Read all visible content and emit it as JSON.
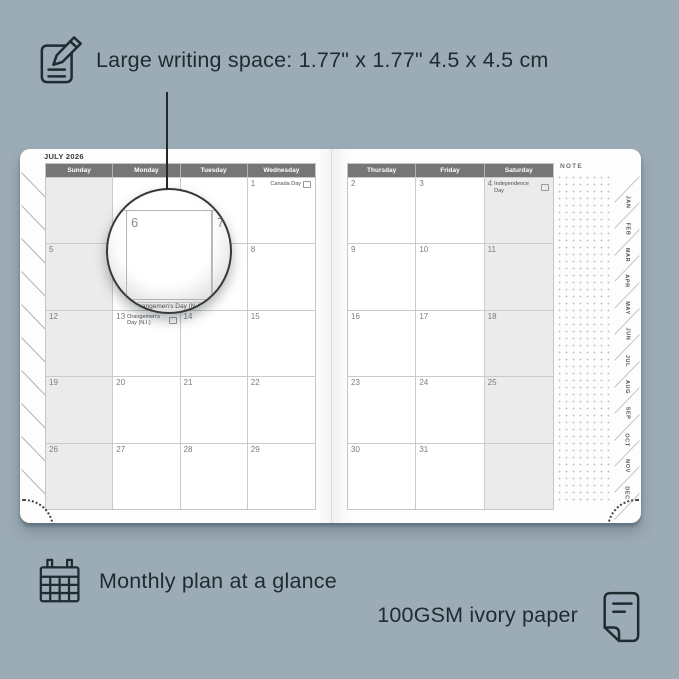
{
  "colors": {
    "background": "#9cacb6",
    "ink": "#1f2a31",
    "page": "#fdfdfd",
    "header_bar": "#767676",
    "grid_line": "#cbcbcb",
    "shaded_column": "#ebebeb"
  },
  "annotations": {
    "writing_space": "Large writing space: 1.77\" x 1.77\" 4.5 x 4.5 cm",
    "monthly_plan": "Monthly plan at a glance",
    "paper": "100GSM ivory paper"
  },
  "planner": {
    "month_title": "JULY 2026",
    "note_label": "NOTE",
    "left_page": {
      "day_headers": [
        "Sunday",
        "Monday",
        "Tuesday",
        "Wednesday"
      ],
      "shaded_column": 0,
      "weeks": [
        [
          "",
          "",
          "",
          "1"
        ],
        [
          "5",
          "6",
          "7",
          "8"
        ],
        [
          "12",
          "13",
          "14",
          "15"
        ],
        [
          "19",
          "20",
          "21",
          "22"
        ],
        [
          "26",
          "27",
          "28",
          "29"
        ]
      ]
    },
    "right_page": {
      "day_headers": [
        "Thursday",
        "Friday",
        "Saturday"
      ],
      "shaded_column": 2,
      "weeks": [
        [
          "2",
          "3",
          "4"
        ],
        [
          "9",
          "10",
          "11"
        ],
        [
          "16",
          "17",
          "18"
        ],
        [
          "23",
          "24",
          "25"
        ],
        [
          "30",
          "31",
          ""
        ]
      ]
    },
    "holidays": {
      "1": "Canada Day",
      "4": "Independence Day",
      "13": "Orangemen's Day (N.I.)"
    },
    "month_tabs": [
      "JAN",
      "FEB",
      "MAR",
      "APR",
      "MAY",
      "JUN",
      "JUL",
      "AUG",
      "SEP",
      "OCT",
      "NOV",
      "DEC"
    ]
  },
  "magnifier": {
    "left_day": "6",
    "right_day": "7",
    "event_date": "13",
    "event": "Orangemen's Day (N.I.)"
  }
}
